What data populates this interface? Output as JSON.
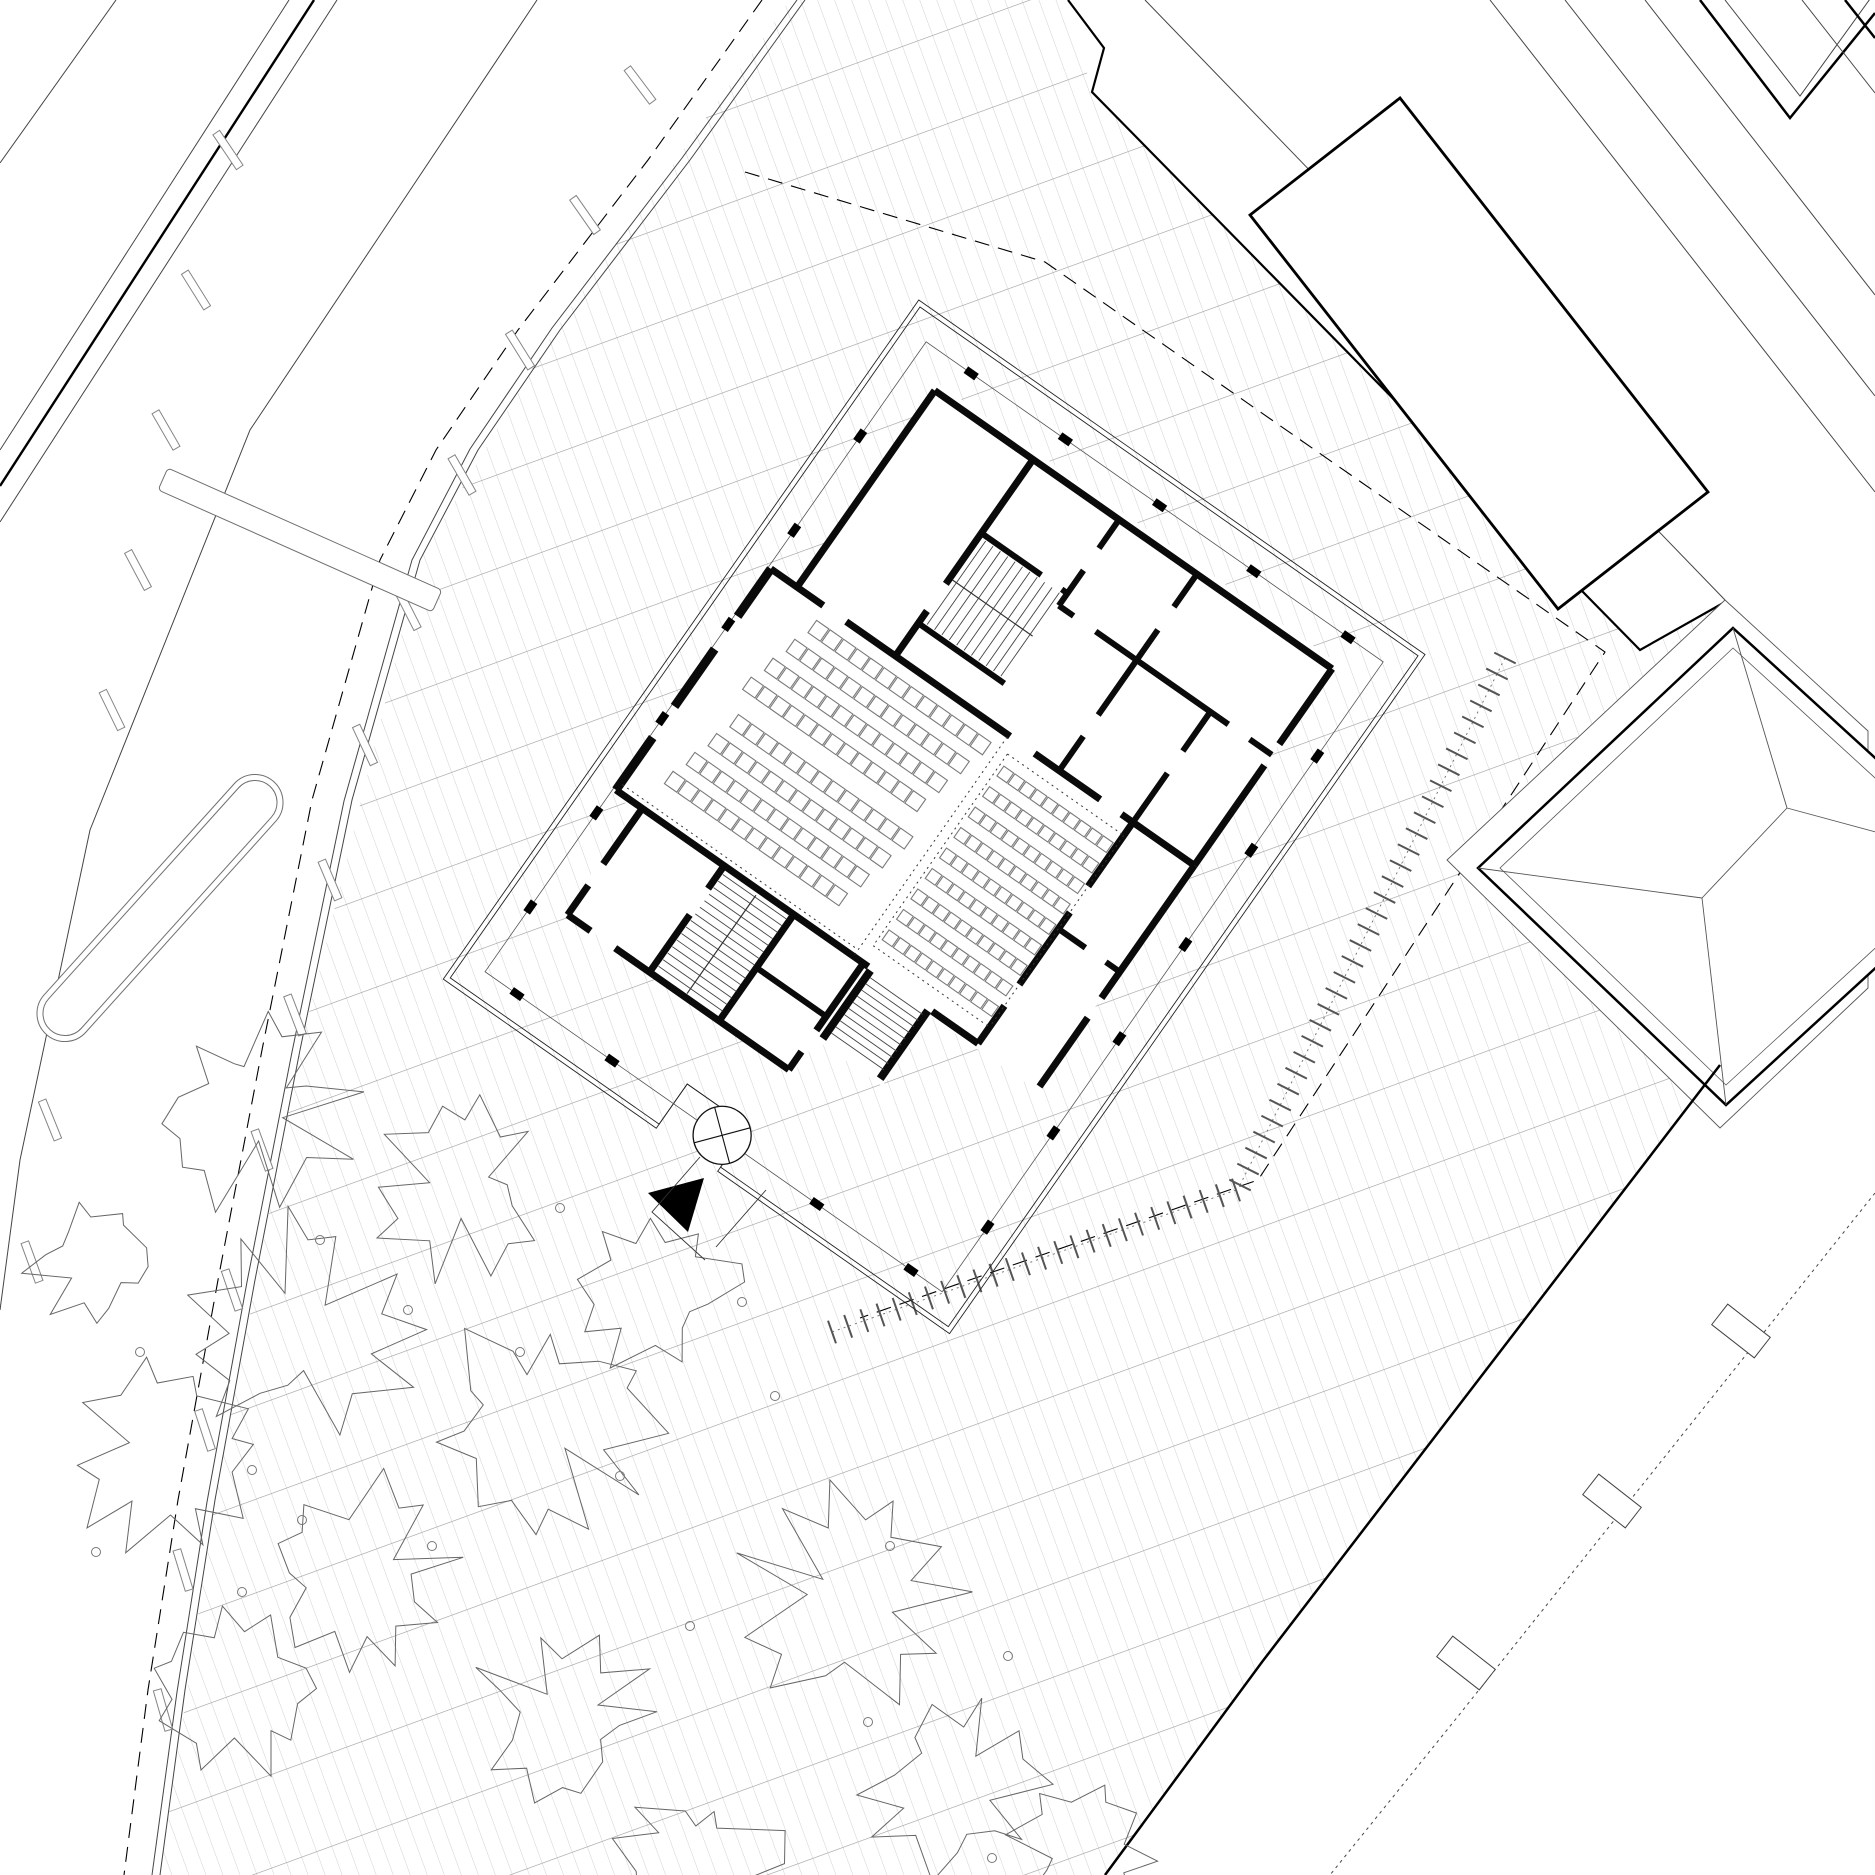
{
  "meta": {
    "width": 1875,
    "height": 1875,
    "background": "#ffffff",
    "ink": "#000000",
    "wall_color": "#0a0a0a",
    "thin_color": "#333333",
    "road_line_color": "#444444",
    "seat_color": "#7a7a7a",
    "tree_color": "#666666",
    "tick_color": "#555555"
  },
  "paving": {
    "polygon": [
      [
        790,
        0
      ],
      [
        555,
        330
      ],
      [
        420,
        560
      ],
      [
        300,
        1050
      ],
      [
        215,
        1500
      ],
      [
        160,
        1875
      ],
      [
        1105,
        1875
      ],
      [
        1262,
        1662
      ],
      [
        1720,
        1065
      ],
      [
        1447,
        858
      ],
      [
        1725,
        600
      ],
      [
        1640,
        650
      ],
      [
        1092,
        92
      ],
      [
        1068,
        0
      ]
    ],
    "fine_spacing": 16,
    "coarse_spacing": 88,
    "angle": -20,
    "fine_color": "#c6c6c6",
    "coarse_color": "#9c9c9c",
    "fine_width": 0.8,
    "coarse_width": 1.2
  },
  "road": {
    "left_lines": [
      {
        "pts": [
          [
            116,
            0
          ],
          [
            0,
            163
          ]
        ],
        "w": 1
      },
      {
        "pts": [
          [
            289,
            0
          ],
          [
            0,
            450
          ]
        ],
        "w": 1
      },
      {
        "pts": [
          [
            314,
            0
          ],
          [
            0,
            486
          ]
        ],
        "w": 2.4
      },
      {
        "pts": [
          [
            337,
            0
          ],
          [
            0,
            522
          ]
        ],
        "w": 1
      },
      {
        "pts": [
          [
            537,
            0
          ],
          [
            250,
            430
          ],
          [
            90,
            830
          ],
          [
            20,
            1160
          ],
          [
            0,
            1310
          ]
        ],
        "w": 1
      }
    ],
    "kerb": [
      [
        805,
        0
      ],
      [
        690,
        160
      ],
      [
        560,
        330
      ],
      [
        478,
        450
      ],
      [
        420,
        560
      ],
      [
        352,
        800
      ],
      [
        300,
        1050
      ],
      [
        255,
        1280
      ],
      [
        215,
        1500
      ],
      [
        185,
        1690
      ],
      [
        160,
        1875
      ]
    ],
    "kerb_inner": [
      [
        797,
        0
      ],
      [
        682,
        158
      ],
      [
        552,
        328
      ],
      [
        470,
        449
      ],
      [
        412,
        560
      ],
      [
        344,
        801
      ],
      [
        292,
        1052
      ],
      [
        247,
        1282
      ],
      [
        207,
        1502
      ],
      [
        177,
        1692
      ],
      [
        152,
        1875
      ]
    ],
    "dashed_property": [
      [
        762,
        0
      ],
      [
        648,
        160
      ],
      [
        518,
        330
      ],
      [
        436,
        450
      ],
      [
        380,
        560
      ],
      [
        312,
        800
      ],
      [
        262,
        1050
      ],
      [
        218,
        1280
      ],
      [
        178,
        1500
      ],
      [
        148,
        1690
      ],
      [
        124,
        1875
      ]
    ],
    "branch_dashed": [
      [
        745,
        172
      ],
      [
        1045,
        262
      ],
      [
        1605,
        652
      ],
      [
        1258,
        1180
      ],
      [
        860,
        1318
      ]
    ],
    "lane_dashes": [
      [
        228,
        150,
        56
      ],
      [
        196,
        290,
        58
      ],
      [
        166,
        430,
        60
      ],
      [
        138,
        570,
        62
      ],
      [
        112,
        710,
        64
      ],
      [
        50,
        1120,
        68
      ],
      [
        32,
        1262,
        70
      ],
      [
        640,
        85,
        53
      ],
      [
        585,
        215,
        55
      ],
      [
        520,
        350,
        58
      ],
      [
        462,
        475,
        60
      ],
      [
        408,
        610,
        63
      ],
      [
        365,
        745,
        65
      ],
      [
        330,
        880,
        67
      ],
      [
        295,
        1015,
        69
      ],
      [
        262,
        1150,
        70
      ],
      [
        232,
        1290,
        71
      ],
      [
        205,
        1430,
        72
      ],
      [
        183,
        1570,
        73
      ],
      [
        163,
        1710,
        74
      ]
    ],
    "dash_size": [
      42,
      8
    ],
    "island": {
      "cx": 160,
      "cy": 908,
      "len": 340,
      "wid": 56,
      "rot": -48
    },
    "platform": {
      "cx": 300,
      "cy": 540,
      "len": 300,
      "wid": 24,
      "rot": 24
    }
  },
  "hedges": {
    "rows": [
      {
        "a": [
          1505,
          658
        ],
        "b": [
          1240,
          1185
        ],
        "n": 34,
        "half": 12
      },
      {
        "a": [
          1236,
          1190
        ],
        "b": [
          832,
          1332
        ],
        "n": 26,
        "half": 12
      }
    ]
  },
  "neighbors": {
    "band_fill": [
      [
        1068,
        0
      ],
      [
        1145,
        0
      ],
      [
        1725,
        600
      ],
      [
        1640,
        650
      ],
      [
        1092,
        92
      ],
      [
        1104,
        48
      ]
    ],
    "l1_bold": [
      [
        1068,
        0
      ],
      [
        1104,
        48
      ],
      [
        1092,
        92
      ],
      [
        1640,
        650
      ],
      [
        1725,
        602
      ]
    ],
    "l2_thin": [
      [
        1145,
        0
      ],
      [
        1725,
        600
      ]
    ],
    "rect_building": [
      [
        1400,
        98
      ],
      [
        1708,
        492
      ],
      [
        1558,
        609
      ],
      [
        1250,
        215
      ]
    ],
    "corridor_lines": [
      [
        [
          1490,
          0
        ],
        [
          1875,
          492
        ]
      ],
      [
        [
          1565,
          0
        ],
        [
          1875,
          396
        ]
      ],
      [
        [
          1645,
          0
        ],
        [
          1875,
          295
        ]
      ]
    ],
    "corner_shapes": [
      {
        "pts": [
          [
            1700,
            0
          ],
          [
            1790,
            118
          ],
          [
            1875,
            13
          ]
        ],
        "w": 2.5
      },
      {
        "pts": [
          [
            1725,
            0
          ],
          [
            1800,
            96
          ],
          [
            1875,
            -8
          ]
        ],
        "w": 1
      },
      {
        "pts": [
          [
            1802,
            0
          ],
          [
            1875,
            93
          ]
        ],
        "w": 1
      },
      {
        "pts": [
          [
            1845,
            0
          ],
          [
            1875,
            38
          ]
        ],
        "w": 2.5
      }
    ],
    "hip": {
      "enclosure": [
        [
          1725,
          600
        ],
        [
          1868,
          731
        ],
        [
          1868,
          988
        ],
        [
          1720,
          1128
        ],
        [
          1447,
          860
        ]
      ],
      "outline": [
        [
          1733,
          628
        ],
        [
          1990,
          863
        ],
        [
          1726,
          1105
        ],
        [
          1478,
          868
        ]
      ],
      "inner": [
        [
          1733,
          648
        ],
        [
          1968,
          863
        ],
        [
          1726,
          1085
        ],
        [
          1500,
          868
        ]
      ],
      "ridge": [
        [
          1702,
          898
        ],
        [
          1787,
          808
        ]
      ],
      "hips": [
        [
          [
            1787,
            808
          ],
          [
            1733,
            628
          ]
        ],
        [
          [
            1787,
            808
          ],
          [
            1990,
            863
          ]
        ],
        [
          [
            1702,
            898
          ],
          [
            1478,
            868
          ]
        ],
        [
          [
            1702,
            898
          ],
          [
            1726,
            1105
          ]
        ]
      ]
    }
  },
  "se_edge": {
    "bold": [
      [
        1720,
        1065
      ],
      [
        1262,
        1662
      ],
      [
        1105,
        1875
      ]
    ],
    "dotted": [
      [
        1875,
        1193
      ],
      [
        1455,
        1720
      ],
      [
        1330,
        1875
      ]
    ],
    "rects": [
      [
        1741,
        1331,
        38
      ],
      [
        1612,
        1501,
        38
      ],
      [
        1466,
        1663,
        38
      ]
    ],
    "rect_size": [
      54,
      26
    ]
  },
  "trees": {
    "canopies": [
      [
        255,
        1105,
        100
      ],
      [
        460,
        1190,
        88
      ],
      [
        655,
        1290,
        78
      ],
      [
        300,
        1330,
        108
      ],
      [
        540,
        1425,
        112
      ],
      [
        165,
        1455,
        92
      ],
      [
        360,
        1578,
        98
      ],
      [
        850,
        1600,
        106
      ],
      [
        565,
        1715,
        88
      ],
      [
        235,
        1688,
        82
      ],
      [
        958,
        1788,
        86
      ],
      [
        700,
        1862,
        78
      ],
      [
        1082,
        1856,
        72
      ],
      [
        92,
        1262,
        62
      ]
    ],
    "trunks": [
      [
        320,
        1240
      ],
      [
        520,
        1352
      ],
      [
        252,
        1470
      ],
      [
        432,
        1546
      ],
      [
        620,
        1476
      ],
      [
        775,
        1396
      ],
      [
        890,
        1546
      ],
      [
        1008,
        1656
      ],
      [
        140,
        1352
      ],
      [
        96,
        1552
      ],
      [
        690,
        1626
      ],
      [
        242,
        1592
      ],
      [
        868,
        1722
      ],
      [
        992,
        1858
      ],
      [
        742,
        1302
      ],
      [
        560,
        1208
      ],
      [
        408,
        1310
      ],
      [
        302,
        1520
      ]
    ],
    "trunk_r": 4.5
  },
  "building": {
    "origin": [
      920,
      307
    ],
    "rotation": 35,
    "envelope": {
      "w": 608,
      "h": 819,
      "notch_x1": 255,
      "notch_x2": 330,
      "notch_y": 770,
      "offset": 5
    },
    "colonnade": {
      "rect": [
        25,
        25,
        583,
        794
      ],
      "col_size": [
        13,
        8
      ],
      "top_xs": [
        80,
        195,
        310,
        425,
        540
      ],
      "bottom_xs": [
        64,
        180,
        430,
        545
      ],
      "side_ys": [
        140,
        255,
        370,
        485,
        600,
        715
      ]
    },
    "mass_polygon": [
      [
        60,
        52
      ],
      [
        545,
        52
      ],
      [
        545,
        575
      ],
      [
        416,
        575
      ],
      [
        416,
        660
      ],
      [
        336,
        660
      ],
      [
        336,
        700
      ],
      [
        56,
        700
      ],
      [
        56,
        575
      ],
      [
        24,
        575
      ],
      [
        24,
        296
      ],
      [
        60,
        296
      ]
    ],
    "walls": [
      [
        60,
        60,
        545,
        60,
        7
      ],
      [
        60,
        60,
        60,
        300,
        7
      ],
      [
        545,
        60,
        545,
        152,
        7
      ],
      [
        545,
        178,
        545,
        300,
        7
      ],
      [
        545,
        300,
        545,
        462,
        7
      ],
      [
        545,
        486,
        545,
        570,
        7
      ],
      [
        28,
        300,
        28,
        358,
        9
      ],
      [
        28,
        398,
        28,
        468,
        9
      ],
      [
        28,
        506,
        28,
        570,
        9
      ],
      [
        28,
        300,
        92,
        300,
        7
      ],
      [
        120,
        300,
        320,
        300,
        7
      ],
      [
        350,
        300,
        430,
        300,
        7
      ],
      [
        456,
        300,
        545,
        300,
        7
      ],
      [
        180,
        60,
        180,
        212,
        7
      ],
      [
        180,
        245,
        180,
        300,
        7
      ],
      [
        285,
        60,
        285,
        95,
        6
      ],
      [
        285,
        122,
        285,
        165,
        6
      ],
      [
        380,
        60,
        380,
        100,
        6
      ],
      [
        380,
        128,
        380,
        232,
        6
      ],
      [
        380,
        258,
        380,
        300,
        6
      ],
      [
        470,
        165,
        470,
        213,
        6
      ],
      [
        470,
        240,
        470,
        300,
        6
      ],
      [
        180,
        150,
        253,
        150,
        6
      ],
      [
        278,
        150,
        285,
        150,
        6
      ],
      [
        285,
        165,
        303,
        165,
        6
      ],
      [
        330,
        165,
        492,
        165,
        6
      ],
      [
        518,
        165,
        545,
        165,
        6
      ],
      [
        180,
        260,
        285,
        260,
        6
      ],
      [
        470,
        300,
        470,
        378,
        7
      ],
      [
        470,
        410,
        470,
        498,
        7
      ],
      [
        470,
        524,
        470,
        570,
        7
      ],
      [
        470,
        430,
        503,
        430,
        6
      ],
      [
        528,
        430,
        545,
        430,
        6
      ],
      [
        28,
        570,
        336,
        570,
        7
      ],
      [
        414,
        570,
        470,
        570,
        7
      ],
      [
        60,
        570,
        60,
        638,
        7
      ],
      [
        60,
        664,
        60,
        700,
        7
      ],
      [
        60,
        700,
        88,
        700,
        7
      ],
      [
        118,
        700,
        330,
        700,
        7
      ],
      [
        160,
        570,
        160,
        598,
        7
      ],
      [
        160,
        630,
        160,
        700,
        7
      ],
      [
        245,
        570,
        245,
        700,
        7
      ],
      [
        330,
        570,
        330,
        652,
        7
      ],
      [
        330,
        678,
        330,
        700,
        7
      ],
      [
        245,
        635,
        330,
        635,
        6
      ],
      [
        340,
        572,
        340,
        655,
        8
      ],
      [
        410,
        572,
        410,
        655,
        8
      ]
    ],
    "stairs": [
      {
        "dir": "v",
        "x": 188,
        "y": 154,
        "w": 90,
        "h": 102,
        "step": 9,
        "rail": [
          183,
          205,
          281,
          205
        ]
      },
      {
        "dir": "h",
        "x": 164,
        "y": 578,
        "w": 78,
        "h": 116,
        "step": 8,
        "rail": [
          203,
          576,
          203,
          696
        ]
      },
      {
        "dir": "h",
        "x": 344,
        "y": 578,
        "w": 64,
        "h": 72,
        "step": 7.5,
        "rail": null
      }
    ],
    "seat_blocks": [
      {
        "x": 95,
        "y": 316,
        "rows": 4,
        "cols": 13,
        "sw": 15,
        "sh": 15,
        "stepx": 16.5,
        "pitch": 28,
        "lean": -7
      },
      {
        "x": 85,
        "y": 438,
        "rows": 4,
        "cols": 13,
        "sw": 15,
        "sh": 15,
        "stepx": 16.5,
        "pitch": 28,
        "lean": -7
      },
      {
        "x": 332,
        "y": 328,
        "rows": 9,
        "cols": 10,
        "sw": 12,
        "sh": 12,
        "stepx": 13.5,
        "pitch": 25,
        "lean": 0
      }
    ],
    "dotted_lines": [
      [
        318,
        302,
        318,
        568
      ],
      [
        328,
        316,
        328,
        550
      ],
      [
        328,
        316,
        470,
        316
      ],
      [
        470,
        316,
        470,
        550
      ],
      [
        328,
        550,
        470,
        550
      ],
      [
        30,
        562,
        316,
        562
      ]
    ],
    "entry_circle": {
      "cx": 313,
      "cy": 792,
      "r": 29
    }
  },
  "entrance_screen": {
    "triangle": [
      [
        648,
        1193
      ],
      [
        704,
        1178
      ],
      [
        688,
        1232
      ]
    ],
    "walk_lines": [
      [
        [
          700,
          1157
        ],
        [
          652,
          1212
        ],
        [
          705,
          1260
        ]
      ],
      [
        [
          766,
          1190
        ],
        [
          716,
          1247
        ]
      ]
    ]
  }
}
